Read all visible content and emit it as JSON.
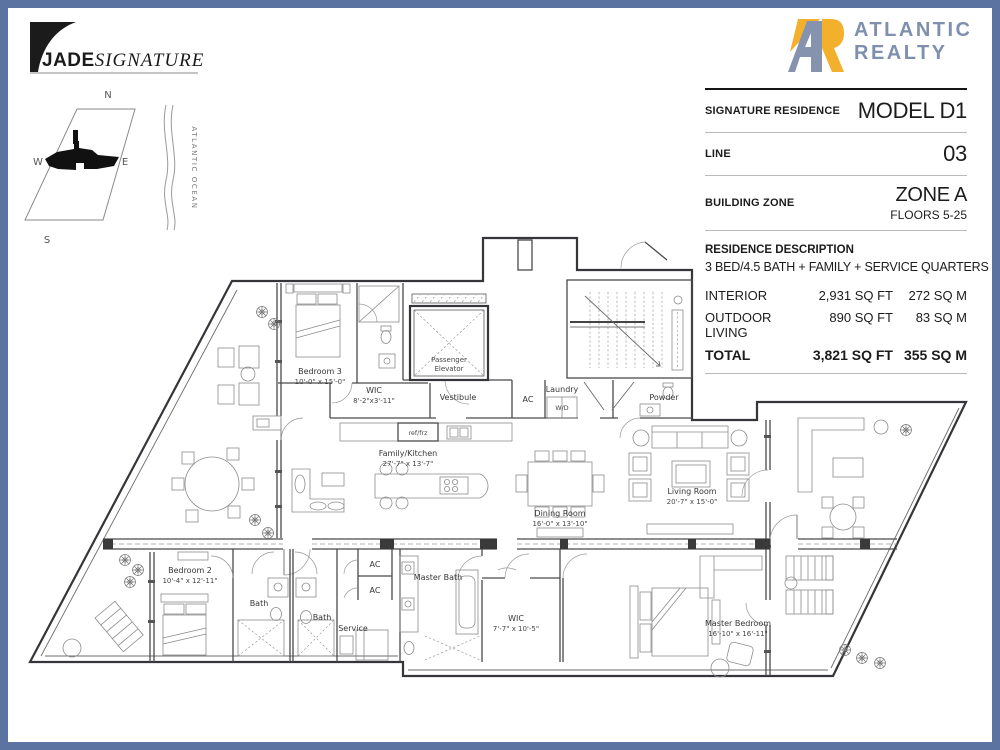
{
  "brand": {
    "jade": "JADE",
    "signature": "SIGNATURE",
    "atlantic": "ATLANTIC",
    "realty": "REALTY"
  },
  "colors": {
    "frame": "#5a73a0",
    "realty_blue": "#7e90ad",
    "realty_yellow": "#f2b02c"
  },
  "info": {
    "row1_label": "SIGNATURE RESIDENCE",
    "row1_value": "MODEL D1",
    "row2_label": "LINE",
    "row2_value": "03",
    "row3_label": "BUILDING ZONE",
    "row3_value": "ZONE A",
    "row3_value2": "FLOORS 5-25",
    "desc_title": "RESIDENCE DESCRIPTION",
    "desc_text": "3 BED/4.5 BATH + FAMILY + SERVICE QUARTERS",
    "areas": [
      {
        "label": "INTERIOR",
        "sqft": "2,931 SQ FT",
        "sqm": "272 SQ M"
      },
      {
        "label": "OUTDOOR LIVING",
        "sqft": "890 SQ FT",
        "sqm": "83 SQ M"
      },
      {
        "label": "TOTAL",
        "sqft": "3,821 SQ FT",
        "sqm": "355 SQ M"
      }
    ]
  },
  "compass": {
    "n": "N",
    "s": "S",
    "w": "W",
    "e": "E",
    "ocean": "ATLANTIC OCEAN"
  },
  "plan": {
    "rooms": [
      {
        "label1": "Bedroom 3",
        "label2": "10'-0\" x 15'-0\""
      },
      {
        "label1": "WIC",
        "label2": "8'-2\"x3'-11\""
      },
      {
        "label1": "Passenger",
        "label2": "Elevator"
      },
      {
        "label1": "Vestibule"
      },
      {
        "label1": "AC"
      },
      {
        "label1": "Laundry"
      },
      {
        "label1": "W/D"
      },
      {
        "label1": "Powder"
      },
      {
        "label1": "ref/frz"
      },
      {
        "label1": "Family/Kitchen",
        "label2": "27'-7\" x 13'-7\""
      },
      {
        "label1": "Dining Room",
        "label2": "16'-0\" x 13'-10\""
      },
      {
        "label1": "Living Room",
        "label2": "20'-7\" x 15'-0\""
      },
      {
        "label1": "Bedroom 2",
        "label2": "10'-4\" x 12'-11\""
      },
      {
        "label1": "Bath"
      },
      {
        "label1": "Bath"
      },
      {
        "label1": "Service"
      },
      {
        "label1": "AC"
      },
      {
        "label1": "AC"
      },
      {
        "label1": "Master Bath"
      },
      {
        "label1": "WIC",
        "label2": "7'-7\" x 10'-5\""
      },
      {
        "label1": "Master Bedroom",
        "label2": "16'-10\" x 16'-11\""
      }
    ]
  }
}
